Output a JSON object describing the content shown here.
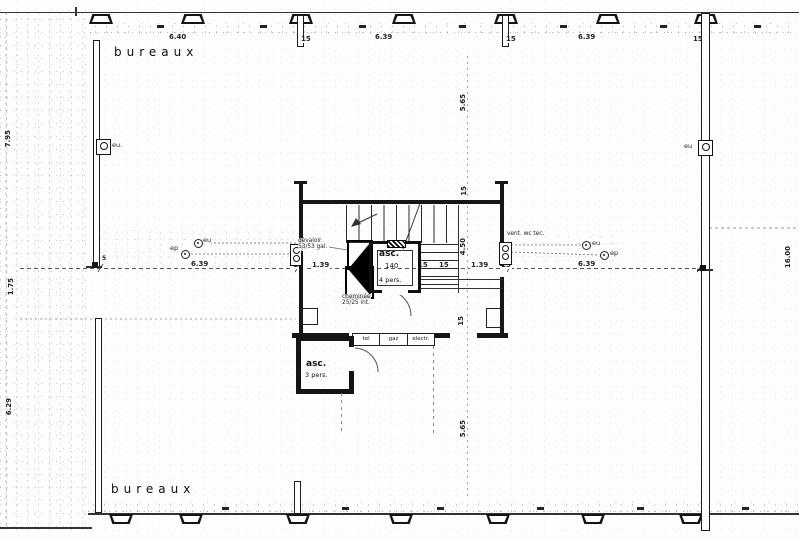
{
  "rooms": {
    "top": "bureaux",
    "bottom": "bureaux"
  },
  "dims": {
    "top": [
      "6.40",
      "15",
      "6.39",
      "15",
      "6.39",
      "15"
    ],
    "left": [
      "7.95",
      "1.75",
      "6.29"
    ],
    "right": [
      "16.00"
    ],
    "center_vertical": [
      "5.65",
      "15",
      "4.50",
      "15",
      "5.65"
    ],
    "mid_chain": [
      "6.39",
      "15",
      "1.39",
      "15",
      "15",
      "1.39",
      "15",
      "6.39"
    ],
    "wall_joint": "5"
  },
  "core": {
    "elevator_main": {
      "label": "asc.",
      "width": "140",
      "capacity": "4 pers."
    },
    "elevator_service": {
      "label": "asc.",
      "capacity": "3 pers."
    },
    "chute": {
      "line1": "dévaloir",
      "line2": "53/53 gal."
    },
    "chimney": {
      "line1": "cheminée",
      "line2": "25/25 int."
    },
    "vent_label": "vent. wc tec.",
    "utilities": [
      "tel",
      "gaz",
      "electr."
    ]
  },
  "drains": {
    "left_eu": "eu",
    "left_ep": "ep",
    "right_eu": "eu",
    "right_ep": "ep",
    "wall_left": "eu.",
    "wall_right": "eu"
  }
}
